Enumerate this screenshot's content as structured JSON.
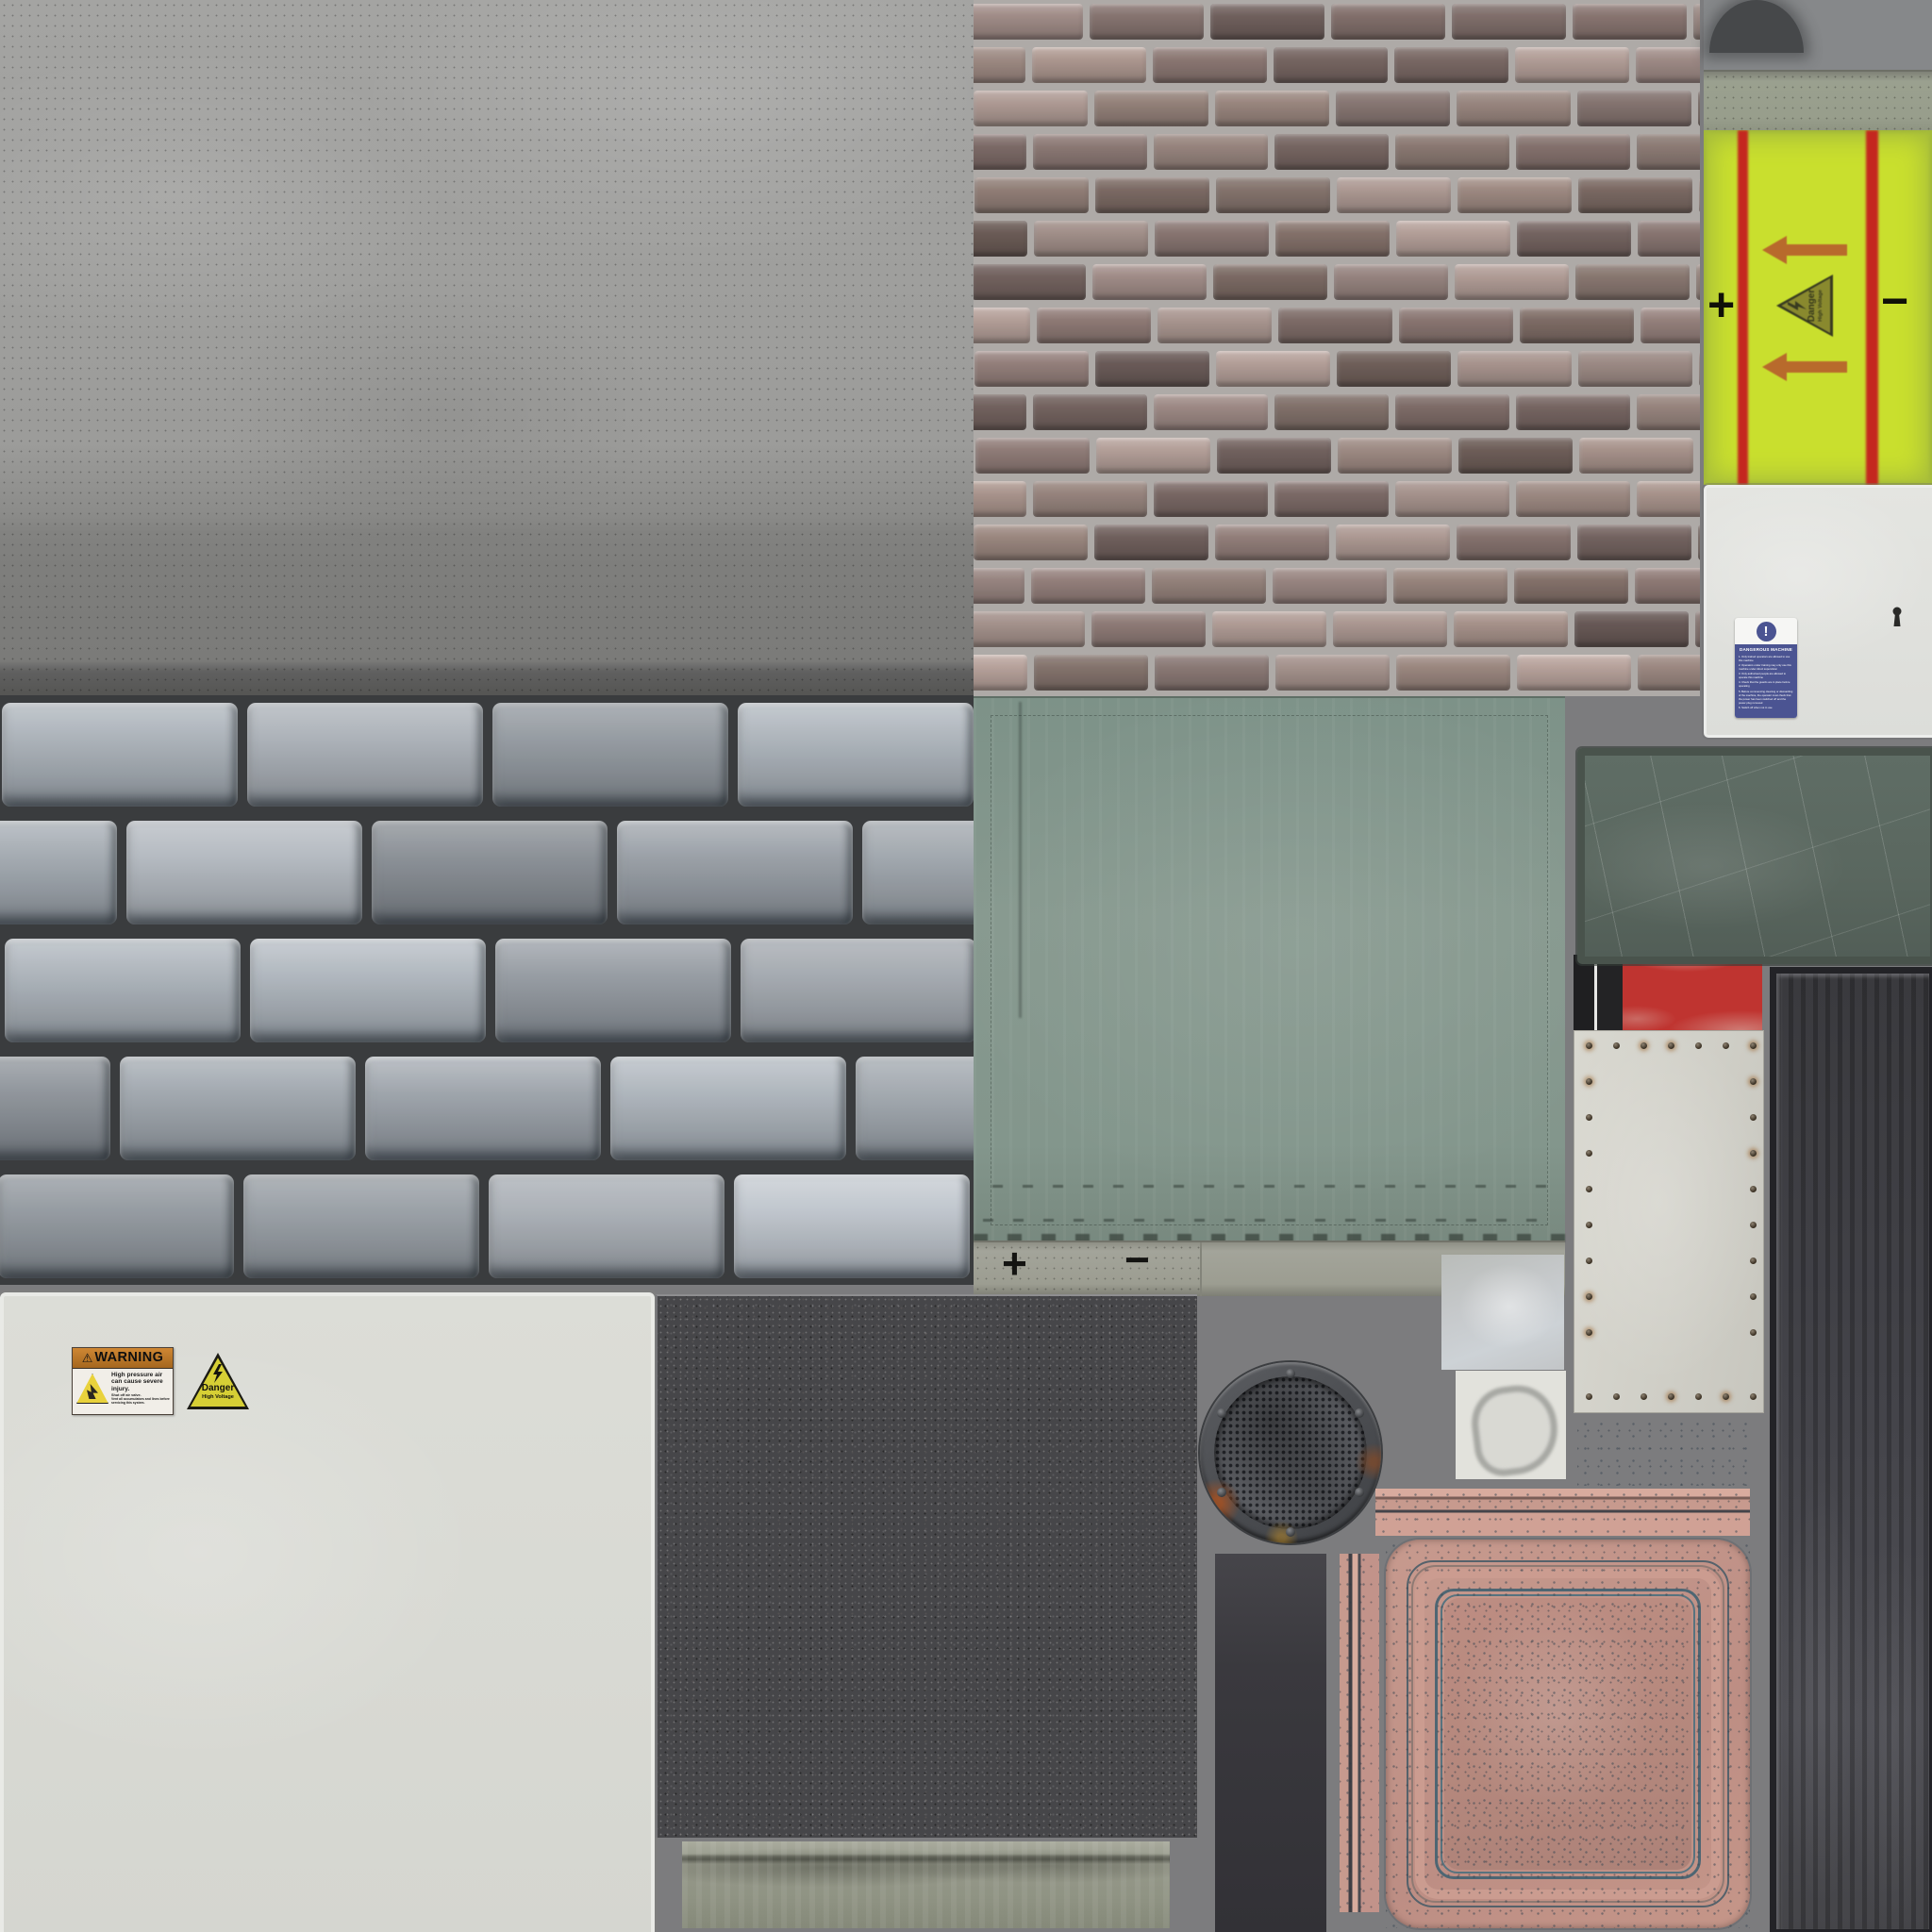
{
  "atlas": {
    "background": "#7c7c7e",
    "labels": {
      "battery_plus": "+",
      "battery_minus": "−",
      "ledge_plus": "+",
      "ledge_minus": "−"
    },
    "danger_sign": {
      "title": "Danger",
      "subtitle": "High Voltage"
    },
    "warning_sticker": {
      "warn_glyph": "⚠",
      "header": "WARNING",
      "line1": "High pressure air can cause severe injury.",
      "line2": "Shut off air valve.",
      "line3": "Vent all accumulators and lines before servicing this system."
    },
    "machine_sticker": {
      "icon": "!",
      "title": "DANGEROUS MACHINE",
      "items": [
        "1. Only trained operators are allowed to use this machine",
        "2. Operators under training may only use this machine under direct supervision",
        "3. Only authorised people are allowed to operate this machine",
        "4. Check that the guards are in place before operating",
        "5. Before commencing cleaning or dismantling of the machine, the operator must check that the power has been switched off and the power plug removed",
        "6. Switch off when not in use"
      ]
    },
    "palettes": {
      "brick": {
        "mortar": "#aeaaa7",
        "bricks": [
          "#8f7d79",
          "#7e6c68",
          "#99867f",
          "#6f5f5c",
          "#a5928c",
          "#84726e",
          "#76655f",
          "#8d7b74"
        ]
      },
      "stone": {
        "mortar": "#3a3c3e",
        "faces": [
          "#aab0b7",
          "#9aa1a8",
          "#b3b9c0",
          "#8f959c",
          "#a2a9b0"
        ]
      },
      "battery": {
        "yellow": "#c9df2e",
        "red": "#c4271f",
        "arrow": "#b86a2c"
      },
      "copper": {
        "base": "#c2938a",
        "light": "#d8ab9e",
        "dark": "#4e5a63"
      },
      "riveted": {
        "panel": "#d7d6ce",
        "red": "#bf3430",
        "black": "#1f1f21"
      },
      "green_panel": "#87998f",
      "green_plate": "#5d6a62",
      "asphalt": "#464649"
    }
  }
}
